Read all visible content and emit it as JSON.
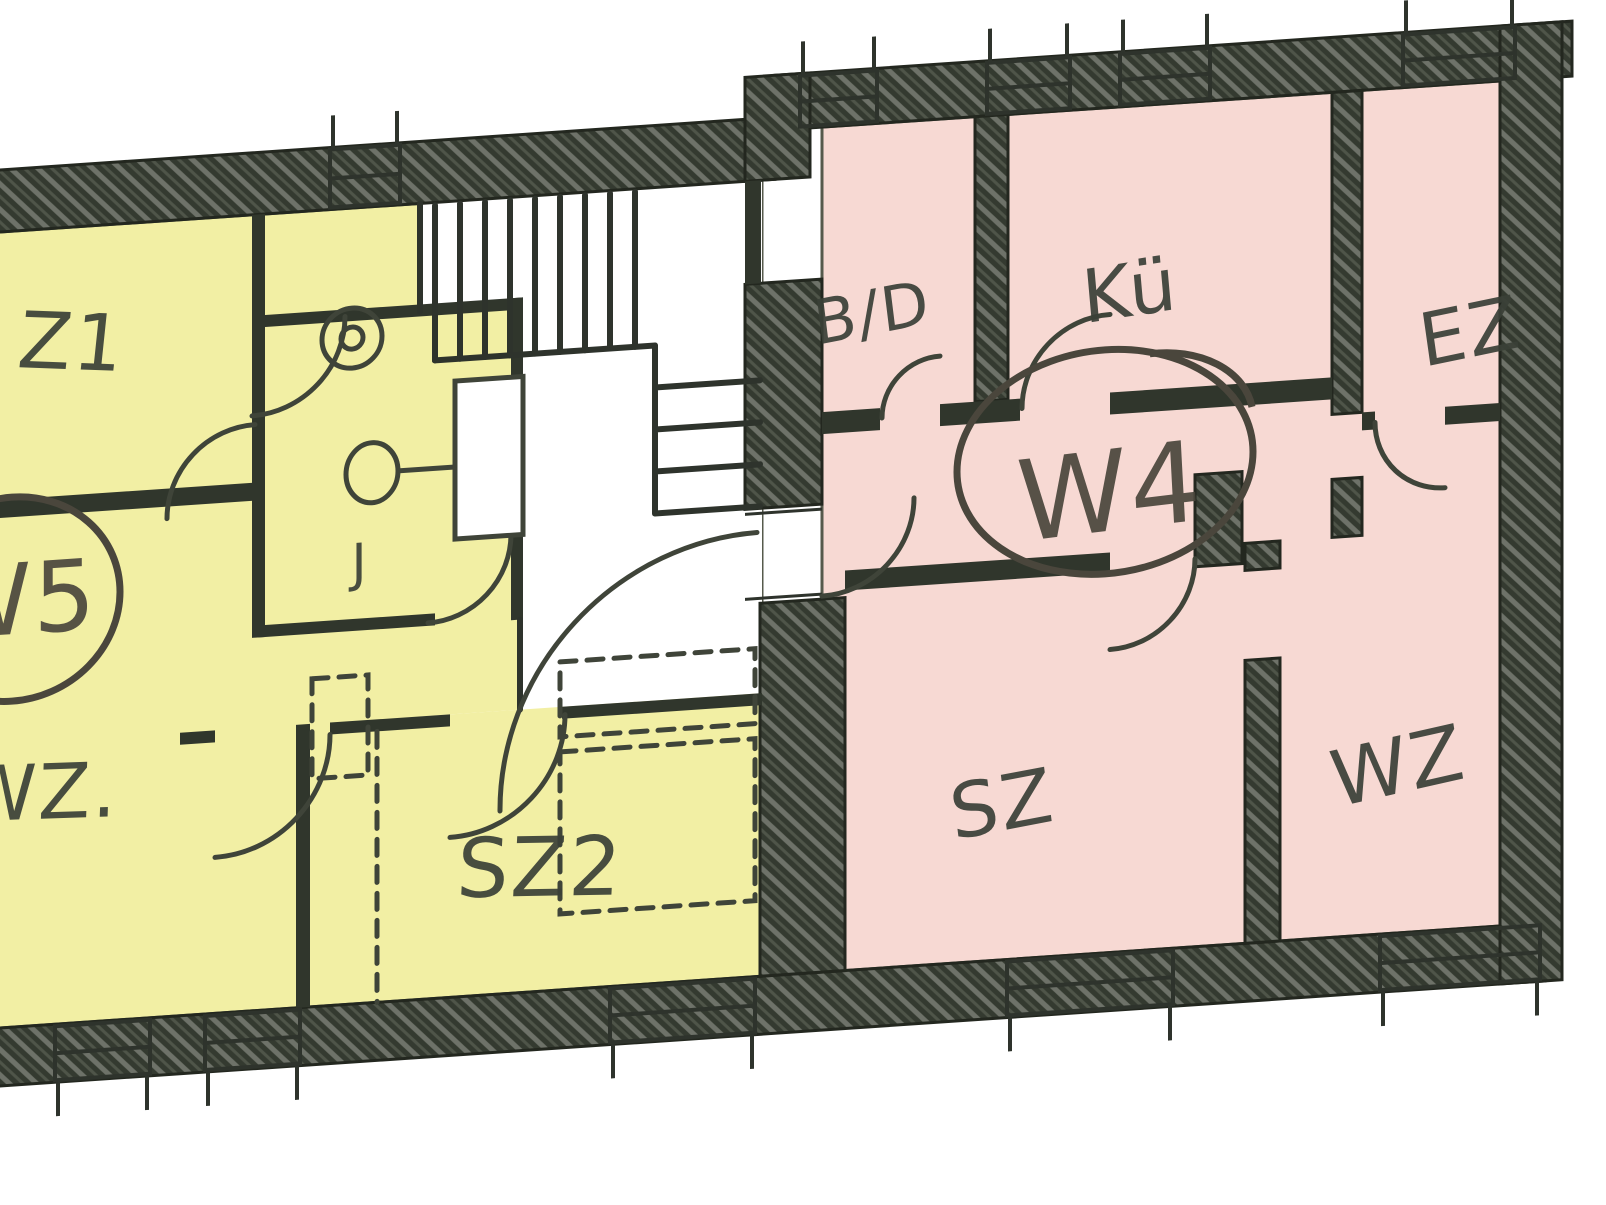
{
  "apartments": {
    "w5": {
      "badge": "W5",
      "highlight_color": "#f2efa4",
      "rooms": {
        "z1": "Z1",
        "wz": "WZ.",
        "sz2": "SZ2",
        "wc": "J"
      }
    },
    "w4": {
      "badge": "W4",
      "highlight_color": "#f7d9d3",
      "rooms": {
        "bad": "B/D",
        "kueche": "Kü",
        "ez": "EZ",
        "sz": "SZ",
        "wz": "WZ"
      }
    }
  },
  "colors": {
    "paper": "#ffffff",
    "wall": "#343a30",
    "ink": "#3a4037",
    "line": "#3f4439",
    "annotation": "#4a463c"
  }
}
